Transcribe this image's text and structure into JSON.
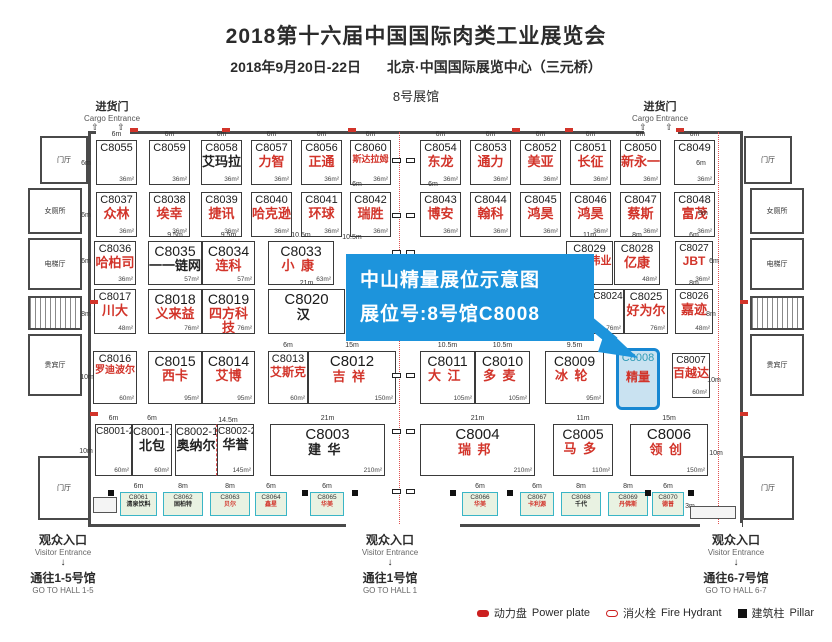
{
  "colors": {
    "accent_blue": "#1d94dc",
    "booth_name_red": "#d2342a",
    "highlight_fill": "#c9e2f1",
    "highlight_border": "#1787d2",
    "highlight_id_teal": "#2e9ab6",
    "strip_fill": "#e9f2e2",
    "strip_border": "#3ab5c6",
    "wall_gray": "#4a4a4a",
    "legend_red": "#cc2020"
  },
  "header": {
    "title": "2018第十六届中国国际肉类工业展览会",
    "date": "2018年9月20日-22日",
    "venue": "北京·中国国际展览中心（三元桥）",
    "hall": "8号展馆"
  },
  "cargo": {
    "cn": "进货门",
    "en": "Cargo Entrance",
    "door_arrows": "⇧ ⇧",
    "positions": [
      {
        "x": 112
      },
      {
        "x": 660
      }
    ]
  },
  "callout": {
    "line1": "中山精量展位示意图",
    "line2": "展位号:8号馆C8008"
  },
  "rooms": [
    {
      "label": "门厅",
      "x": 40,
      "y": 136,
      "w": 48,
      "h": 48
    },
    {
      "label": "女厕所",
      "x": 28,
      "y": 188,
      "w": 54,
      "h": 46
    },
    {
      "label": "电梯厅",
      "x": 28,
      "y": 238,
      "w": 54,
      "h": 52
    },
    {
      "label": "",
      "x": 28,
      "y": 296,
      "w": 54,
      "h": 34,
      "hatch": true
    },
    {
      "label": "贵宾厅",
      "x": 28,
      "y": 334,
      "w": 54,
      "h": 62
    },
    {
      "label": "门厅",
      "x": 38,
      "y": 456,
      "w": 52,
      "h": 64
    },
    {
      "label": "门厅",
      "x": 744,
      "y": 136,
      "w": 48,
      "h": 48
    },
    {
      "label": "女厕所",
      "x": 750,
      "y": 188,
      "w": 54,
      "h": 46
    },
    {
      "label": "电梯厅",
      "x": 750,
      "y": 238,
      "w": 54,
      "h": 52
    },
    {
      "label": "",
      "x": 750,
      "y": 296,
      "w": 54,
      "h": 34,
      "hatch": true
    },
    {
      "label": "贵宾厅",
      "x": 750,
      "y": 334,
      "w": 54,
      "h": 62
    },
    {
      "label": "门厅",
      "x": 742,
      "y": 456,
      "w": 52,
      "h": 64
    }
  ],
  "booths": [
    {
      "id": "C8055",
      "x": 96,
      "y": 140,
      "w": 41,
      "h": 45,
      "n": "",
      "c": "k",
      "a": "36m²",
      "wl": "6m"
    },
    {
      "id": "C8059",
      "x": 149,
      "y": 140,
      "w": 41,
      "h": 45,
      "n": "",
      "c": "k",
      "a": "36m²",
      "wl": "6m"
    },
    {
      "id": "C8058",
      "x": 201,
      "y": 140,
      "w": 41,
      "h": 45,
      "n": "艾玛拉",
      "c": "k",
      "a": "36m²",
      "wl": "6m"
    },
    {
      "id": "C8057",
      "x": 251,
      "y": 140,
      "w": 41,
      "h": 45,
      "n": "力智",
      "c": "r",
      "a": "36m²",
      "wl": "6m"
    },
    {
      "id": "C8056",
      "x": 301,
      "y": 140,
      "w": 41,
      "h": 45,
      "n": "正通",
      "c": "r",
      "a": "36m²",
      "wl": "6m"
    },
    {
      "id": "C8060",
      "x": 350,
      "y": 140,
      "w": 41,
      "h": 45,
      "n": "斯达拉姆",
      "c": "r",
      "a": "36m²",
      "wl": "6m"
    },
    {
      "id": "C8054",
      "x": 420,
      "y": 140,
      "w": 41,
      "h": 45,
      "n": "东龙",
      "c": "r",
      "a": "36m²",
      "wl": "6m"
    },
    {
      "id": "C8053",
      "x": 470,
      "y": 140,
      "w": 41,
      "h": 45,
      "n": "通力",
      "c": "r",
      "a": "36m²",
      "wl": "6m"
    },
    {
      "id": "C8052",
      "x": 520,
      "y": 140,
      "w": 41,
      "h": 45,
      "n": "美亚",
      "c": "r",
      "a": "36m²",
      "wl": "6m"
    },
    {
      "id": "C8051",
      "x": 570,
      "y": 140,
      "w": 41,
      "h": 45,
      "n": "长征",
      "c": "r",
      "a": "36m²",
      "wl": "6m"
    },
    {
      "id": "C8050",
      "x": 620,
      "y": 140,
      "w": 41,
      "h": 45,
      "n": "新永一",
      "c": "r",
      "a": "36m²",
      "wl": "6m"
    },
    {
      "id": "C8049",
      "x": 674,
      "y": 140,
      "w": 41,
      "h": 45,
      "n": "",
      "c": "k",
      "a": "36m²",
      "wl": "6m"
    },
    {
      "id": "C8037",
      "x": 96,
      "y": 192,
      "w": 41,
      "h": 45,
      "n": "众林",
      "c": "r",
      "a": "36m²"
    },
    {
      "id": "C8038",
      "x": 149,
      "y": 192,
      "w": 41,
      "h": 45,
      "n": "埃幸",
      "c": "r",
      "a": "36m²"
    },
    {
      "id": "C8039",
      "x": 201,
      "y": 192,
      "w": 41,
      "h": 45,
      "n": "捷讯",
      "c": "r",
      "a": "36m²"
    },
    {
      "id": "C8040",
      "x": 251,
      "y": 192,
      "w": 41,
      "h": 45,
      "n": "哈克逊",
      "c": "r",
      "a": "36m²"
    },
    {
      "id": "C8041",
      "x": 301,
      "y": 192,
      "w": 41,
      "h": 45,
      "n": "环球",
      "c": "r",
      "a": "36m²"
    },
    {
      "id": "C8042",
      "x": 350,
      "y": 192,
      "w": 41,
      "h": 45,
      "n": "瑞胜",
      "c": "r",
      "a": "36m²"
    },
    {
      "id": "C8043",
      "x": 420,
      "y": 192,
      "w": 41,
      "h": 45,
      "n": "博安",
      "c": "r",
      "a": "36m²"
    },
    {
      "id": "C8044",
      "x": 470,
      "y": 192,
      "w": 41,
      "h": 45,
      "n": "翰科",
      "c": "r",
      "a": "36m²"
    },
    {
      "id": "C8045",
      "x": 520,
      "y": 192,
      "w": 41,
      "h": 45,
      "n": "鸿昊",
      "c": "r",
      "a": "36m²"
    },
    {
      "id": "C8046",
      "x": 570,
      "y": 192,
      "w": 41,
      "h": 45,
      "n": "鸿昊",
      "c": "r",
      "a": "36m²"
    },
    {
      "id": "C8047",
      "x": 620,
      "y": 192,
      "w": 41,
      "h": 45,
      "n": "蔡斯",
      "c": "r",
      "a": "36m²"
    },
    {
      "id": "C8048",
      "x": 674,
      "y": 192,
      "w": 41,
      "h": 45,
      "n": "富茂",
      "c": "r",
      "a": "36m²"
    },
    {
      "id": "C8036",
      "x": 94,
      "y": 241,
      "w": 42,
      "h": 44,
      "n": "哈柏司",
      "c": "r",
      "a": "36m²"
    },
    {
      "id": "C8035",
      "x": 148,
      "y": 241,
      "w": 54,
      "h": 44,
      "n": "一一链网",
      "c": "k",
      "a": "57m²",
      "wl": "9.5m"
    },
    {
      "id": "C8034",
      "x": 202,
      "y": 241,
      "w": 53,
      "h": 44,
      "n": "连科",
      "c": "r",
      "a": "57m²",
      "wl": "9.5m"
    },
    {
      "id": "C8033",
      "x": 268,
      "y": 241,
      "w": 66,
      "h": 44,
      "n": "小康",
      "c": "r",
      "a": "63m²",
      "wl": "10.5m"
    },
    {
      "id": "C8029",
      "x": 566,
      "y": 241,
      "w": 47,
      "h": 44,
      "n": "德创伟业",
      "c": "r",
      "a": "",
      "wl": "11m"
    },
    {
      "id": "C8028",
      "x": 614,
      "y": 241,
      "w": 46,
      "h": 44,
      "n": "亿康",
      "c": "r",
      "a": "48m²",
      "wl": "8m"
    },
    {
      "id": "C8027",
      "x": 675,
      "y": 241,
      "w": 38,
      "h": 44,
      "n": "JBT",
      "c": "r",
      "a": "36m²",
      "wl": "6m"
    },
    {
      "id": "C8017",
      "x": 94,
      "y": 289,
      "w": 42,
      "h": 45,
      "n": "川大",
      "c": "r",
      "a": "48m²"
    },
    {
      "id": "C8018",
      "x": 148,
      "y": 289,
      "w": 54,
      "h": 45,
      "n": "义来益",
      "c": "r",
      "a": "76m²"
    },
    {
      "id": "C8019",
      "x": 202,
      "y": 289,
      "w": 53,
      "h": 45,
      "n": "四方科技",
      "c": "r",
      "a": "76m²"
    },
    {
      "id": "C8020",
      "x": 268,
      "y": 289,
      "w": 77,
      "h": 45,
      "n": "汉",
      "c": "k",
      "a": "",
      "wl": "21m"
    },
    {
      "id": "C8024",
      "x": 592,
      "y": 289,
      "w": 32,
      "h": 45,
      "n": "",
      "c": "r",
      "a": "76m²"
    },
    {
      "id": "C8025",
      "x": 624,
      "y": 289,
      "w": 44,
      "h": 45,
      "n": "好为尔",
      "c": "r",
      "a": "76m²"
    },
    {
      "id": "C8026",
      "x": 675,
      "y": 289,
      "w": 38,
      "h": 45,
      "n": "嘉迹",
      "c": "r",
      "a": "48m²",
      "wl": "8m"
    },
    {
      "id": "C8016",
      "x": 93,
      "y": 351,
      "w": 44,
      "h": 53,
      "n": "罗迪波尔",
      "c": "r",
      "a": "60m²"
    },
    {
      "id": "C8015",
      "x": 148,
      "y": 351,
      "w": 54,
      "h": 53,
      "n": "西卡",
      "c": "r",
      "a": "95m²"
    },
    {
      "id": "C8014",
      "x": 202,
      "y": 351,
      "w": 53,
      "h": 53,
      "n": "艾博",
      "c": "r",
      "a": "95m²"
    },
    {
      "id": "C8013",
      "x": 268,
      "y": 351,
      "w": 40,
      "h": 53,
      "n": "艾斯克",
      "c": "r",
      "a": "60m²",
      "wl": "6m"
    },
    {
      "id": "C8012",
      "x": 308,
      "y": 351,
      "w": 88,
      "h": 53,
      "n": "吉祥",
      "c": "r",
      "a": "150m²",
      "wl": "15m"
    },
    {
      "id": "C8011",
      "x": 420,
      "y": 351,
      "w": 55,
      "h": 53,
      "n": "大江",
      "c": "r",
      "a": "105m²",
      "wl": "10.5m"
    },
    {
      "id": "C8010",
      "x": 475,
      "y": 351,
      "w": 55,
      "h": 53,
      "n": "多麦",
      "c": "r",
      "a": "105m²",
      "wl": "10.5m"
    },
    {
      "id": "C8009",
      "x": 545,
      "y": 351,
      "w": 59,
      "h": 53,
      "n": "冰轮",
      "c": "r",
      "a": "95m²",
      "wl": "9.5m"
    },
    {
      "id": "C8008",
      "x": 616,
      "y": 348,
      "w": 44,
      "h": 62,
      "n": "精量",
      "c": "r",
      "a": "",
      "hl": true
    },
    {
      "id": "C8007",
      "x": 672,
      "y": 353,
      "w": 38,
      "h": 45,
      "n": "百越达",
      "c": "r",
      "a": "60m²"
    },
    {
      "id": "C8001-2",
      "x": 95,
      "y": 424,
      "w": 37,
      "h": 52,
      "n": "",
      "c": "k",
      "a": "60m²",
      "wl": "6m"
    },
    {
      "id": "C8001-1",
      "x": 132,
      "y": 424,
      "w": 40,
      "h": 52,
      "n": "北包",
      "c": "k",
      "a": "60m²",
      "wl": "6m"
    },
    {
      "id": "C8002-1",
      "x": 175,
      "y": 424,
      "w": 42,
      "h": 52,
      "n": "奥纳尔",
      "c": "k",
      "a": "",
      "f": "dr"
    },
    {
      "id": "C8002-2",
      "x": 217,
      "y": 424,
      "w": 37,
      "h": 52,
      "n": "华誉",
      "c": "k",
      "a": "145m²"
    },
    {
      "id": "C8003",
      "x": 270,
      "y": 424,
      "w": 115,
      "h": 52,
      "n": "建华",
      "c": "k",
      "a": "210m²",
      "wl": "21m"
    },
    {
      "id": "C8004",
      "x": 420,
      "y": 424,
      "w": 115,
      "h": 52,
      "n": "瑞邦",
      "c": "r",
      "a": "210m²",
      "wl": "21m"
    },
    {
      "id": "C8005",
      "x": 553,
      "y": 424,
      "w": 60,
      "h": 52,
      "n": "马多",
      "c": "r",
      "a": "110m²",
      "wl": "11m"
    },
    {
      "id": "C8006",
      "x": 630,
      "y": 424,
      "w": 78,
      "h": 52,
      "n": "领创",
      "c": "r",
      "a": "150m²",
      "wl": "15m"
    }
  ],
  "strip_booths": [
    {
      "id": "C8061",
      "x": 120,
      "w": 37,
      "n": "清泉饮料",
      "c": "k",
      "wl": "6m"
    },
    {
      "id": "C8062",
      "x": 163,
      "w": 40,
      "n": "固柏特",
      "c": "k",
      "wl": "8m"
    },
    {
      "id": "C8063",
      "x": 210,
      "w": 40,
      "n": "贝尔",
      "c": "r",
      "wl": "8m"
    },
    {
      "id": "C8064",
      "x": 255,
      "w": 32,
      "n": "鑫星",
      "c": "r",
      "wl": "6m"
    },
    {
      "id": "C8065",
      "x": 310,
      "w": 34,
      "n": "华美",
      "c": "r",
      "wl": "6m"
    },
    {
      "id": "C8066",
      "x": 462,
      "w": 36,
      "n": "华美",
      "c": "r",
      "wl": "6m"
    },
    {
      "id": "C8067",
      "x": 520,
      "w": 34,
      "n": "卡利源",
      "c": "r",
      "wl": "6m"
    },
    {
      "id": "C8068",
      "x": 561,
      "w": 40,
      "n": "千代",
      "c": "k",
      "wl": "8m"
    },
    {
      "id": "C8069",
      "x": 608,
      "w": 40,
      "n": "丹佛斯",
      "c": "r",
      "wl": "8m"
    },
    {
      "id": "C8070",
      "x": 652,
      "w": 32,
      "n": "德普",
      "c": "r",
      "wl": "6m"
    }
  ],
  "dim_labels": [
    {
      "t": "10.5m",
      "x": 352,
      "y": 234
    },
    {
      "t": "14.5m",
      "x": 228,
      "y": 417
    },
    {
      "t": "6m",
      "x": 357,
      "y": 181
    },
    {
      "t": "6m",
      "x": 433,
      "y": 181
    },
    {
      "t": "6m",
      "x": 86,
      "y": 160
    },
    {
      "t": "6m",
      "x": 86,
      "y": 212
    },
    {
      "t": "6m",
      "x": 86,
      "y": 258
    },
    {
      "t": "8m",
      "x": 86,
      "y": 311
    },
    {
      "t": "10m",
      "x": 87,
      "y": 374
    },
    {
      "t": "10m",
      "x": 86,
      "y": 448
    },
    {
      "t": "6m",
      "x": 701,
      "y": 160
    },
    {
      "t": "6m",
      "x": 703,
      "y": 210
    },
    {
      "t": "6m",
      "x": 714,
      "y": 258
    },
    {
      "t": "8m",
      "x": 711,
      "y": 311
    },
    {
      "t": "10m",
      "x": 714,
      "y": 377
    },
    {
      "t": "10m",
      "x": 716,
      "y": 450
    },
    {
      "t": "3m",
      "x": 110,
      "y": 501
    },
    {
      "t": "3m",
      "x": 690,
      "y": 503
    }
  ],
  "exits": [
    {
      "x": 63,
      "cn": "观众入口",
      "en": "Visitor Entrance",
      "arrow": "↓",
      "dest": "通往1-5号馆",
      "dest_en": "GO TO HALL 1-5"
    },
    {
      "x": 390,
      "cn": "观众入口",
      "en": "Visitor Entrance",
      "arrow": "↓",
      "dest": "通往1号馆",
      "dest_en": "GO TO HALL 1"
    },
    {
      "x": 736,
      "cn": "观众入口",
      "en": "Visitor Entrance",
      "arrow": "↓",
      "dest": "通往6-7号馆",
      "dest_en": "GO TO HALL 6-7"
    }
  ],
  "legend": [
    {
      "icon": "power-plate-icon",
      "cn": "动力盘",
      "en": "Power plate"
    },
    {
      "icon": "fire-hydrant-icon",
      "cn": "消火栓",
      "en": "Fire Hydrant"
    },
    {
      "icon": "pillar-icon",
      "cn": "建筑柱",
      "en": "Pillar"
    }
  ]
}
